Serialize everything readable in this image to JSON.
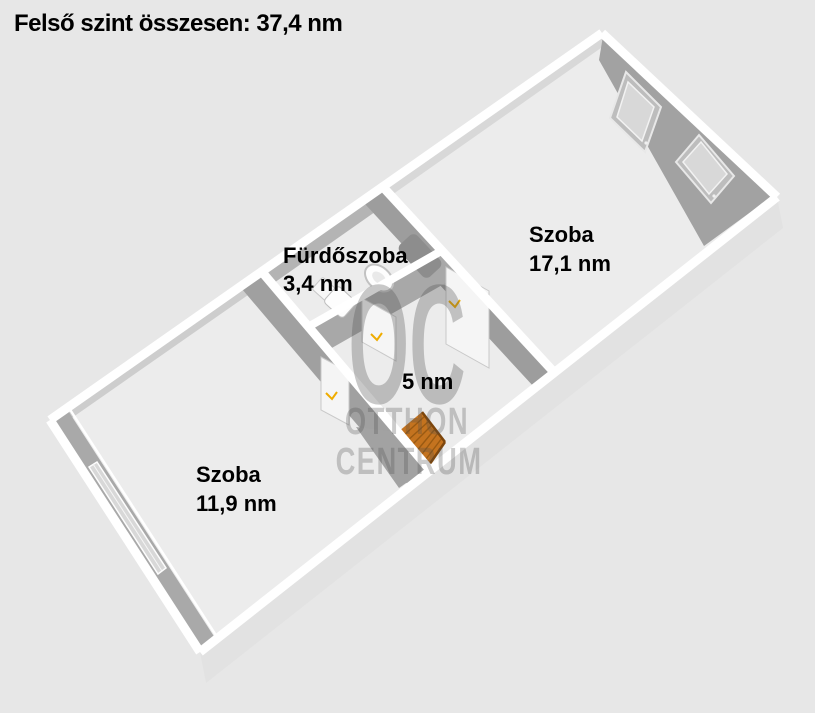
{
  "title": "Felső szint összesen: 37,4 nm",
  "rooms": {
    "bathroom": {
      "name": "Fürdőszoba",
      "area": "3,4 nm"
    },
    "room_large": {
      "name": "Szoba",
      "area": "17,1 nm"
    },
    "hallway": {
      "area": "5 nm"
    },
    "room_small": {
      "name": "Szoba",
      "area": "11,9 nm"
    }
  },
  "watermark": {
    "initials": "OC",
    "line1": "OTTHON",
    "line2": "CENTRUM"
  },
  "colors": {
    "background": "#e7e7e7",
    "floor": "#ececec",
    "wall_top": "#ffffff",
    "wall_face_dark": "#a2a2a2",
    "wall_face_mid": "#9d9d9d",
    "exterior_face": "#e2e2e2",
    "window_glass": "#d8d8d8",
    "door_panel": "#f5f5f5",
    "stairs": "#c4731f",
    "stairs_stripe": "#9a5a12",
    "stairs_edge": "#7d460c",
    "door_handle": "#efac00",
    "label_text": "#000000",
    "watermark_gray": "#4d4d4d"
  }
}
